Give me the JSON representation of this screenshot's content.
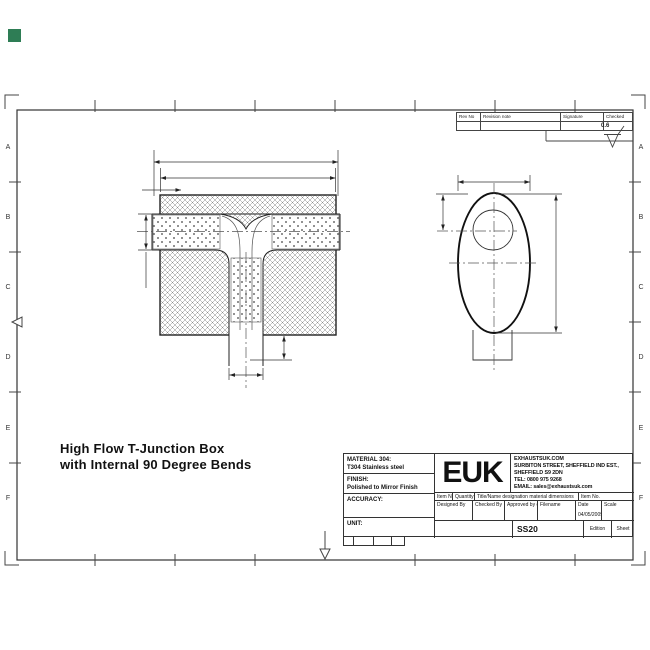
{
  "colors": {
    "corner_square": "#2e7d55",
    "line": "#2b2b2b"
  },
  "drawing": {
    "title_line1": "High Flow T-Junction Box",
    "title_line2": "with Internal 90 Degree Bends"
  },
  "zones": {
    "letters": [
      "A",
      "B",
      "C",
      "D",
      "E",
      "F"
    ]
  },
  "revision_table": {
    "rev_no": "Rev No",
    "revision_note": "Revision note",
    "signature": "Signature",
    "checked": "Checked"
  },
  "surface_finish_value": "0.6",
  "title_block": {
    "material_label": "MATERIAL 304:",
    "material_value": "T304 Stainless steel",
    "finish_label": "FINISH:",
    "finish_value": "Polished to Mirror Finish",
    "accuracy_label": "ACCURACY:",
    "unit_label": "UNIT:",
    "logo_text": "EUK",
    "company_lines": [
      "EXHAUSTSUK.COM",
      "SURBITON STREET, SHEFFIELD IND EST.,",
      "SHEFFIELD S9 2DN",
      "TEL: 0800 975 9268",
      "EMAIL: sales@exhaustsuk.com"
    ],
    "item_row": {
      "item_no": "Item No",
      "quantity": "Quantity",
      "title_name": "Title/Name designation material dimensions",
      "item_no2": "Item No."
    },
    "sign_row": {
      "designed": "Designed By",
      "checked": "Checked By",
      "approved": "Approved by date",
      "filename": "Filename",
      "date": "Date",
      "scale": "Scale"
    },
    "date_value": "04/05/2009",
    "drawing_no": "SS20",
    "edition_label": "Edition",
    "sheet_label": "Sheet"
  }
}
